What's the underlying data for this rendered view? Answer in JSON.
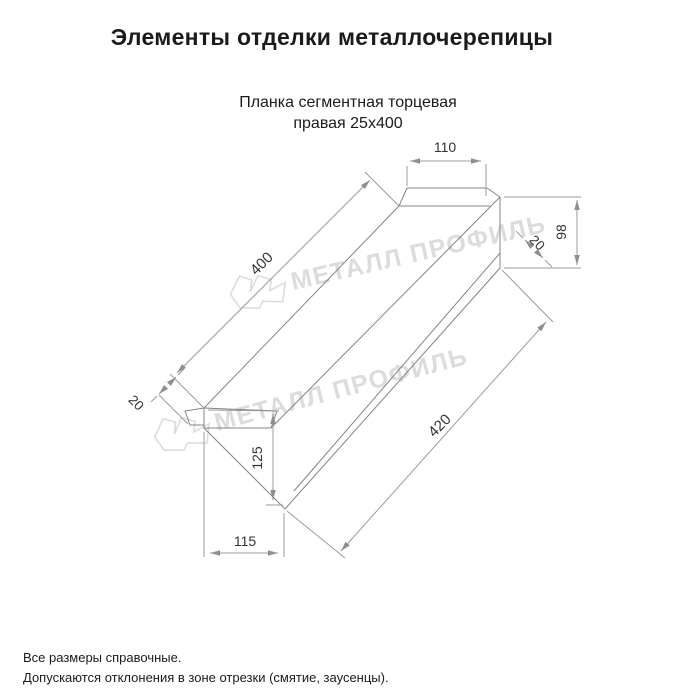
{
  "title": "Элементы отделки металлочерепицы",
  "product": {
    "name_line1": "Планка сегментная торцевая",
    "name_line2": "правая 25х400"
  },
  "drawing": {
    "type": "isometric technical drawing of end trim plank",
    "dimensions": {
      "top_end_width": "110",
      "right_end_height": "98",
      "fold_top_right": "20",
      "length_top_edge": "400",
      "fold_bottom_left": "20",
      "left_end_height": "125",
      "left_end_width": "115",
      "length_bottom_edge": "420"
    },
    "watermark": {
      "text": "МЕТАЛЛ ПРОФИЛЬ",
      "color": "#dcdcdc"
    },
    "colors": {
      "shape_line": "#848484",
      "dimension_line": "#9b9b9b",
      "dimension_text": "#333333",
      "title_text": "#1b1b1b",
      "background": "#ffffff"
    }
  },
  "footer": {
    "note1": "Все размеры справочные.",
    "note2": "Допускаются отклонения в зоне отрезки (смятие, заусенцы)."
  }
}
